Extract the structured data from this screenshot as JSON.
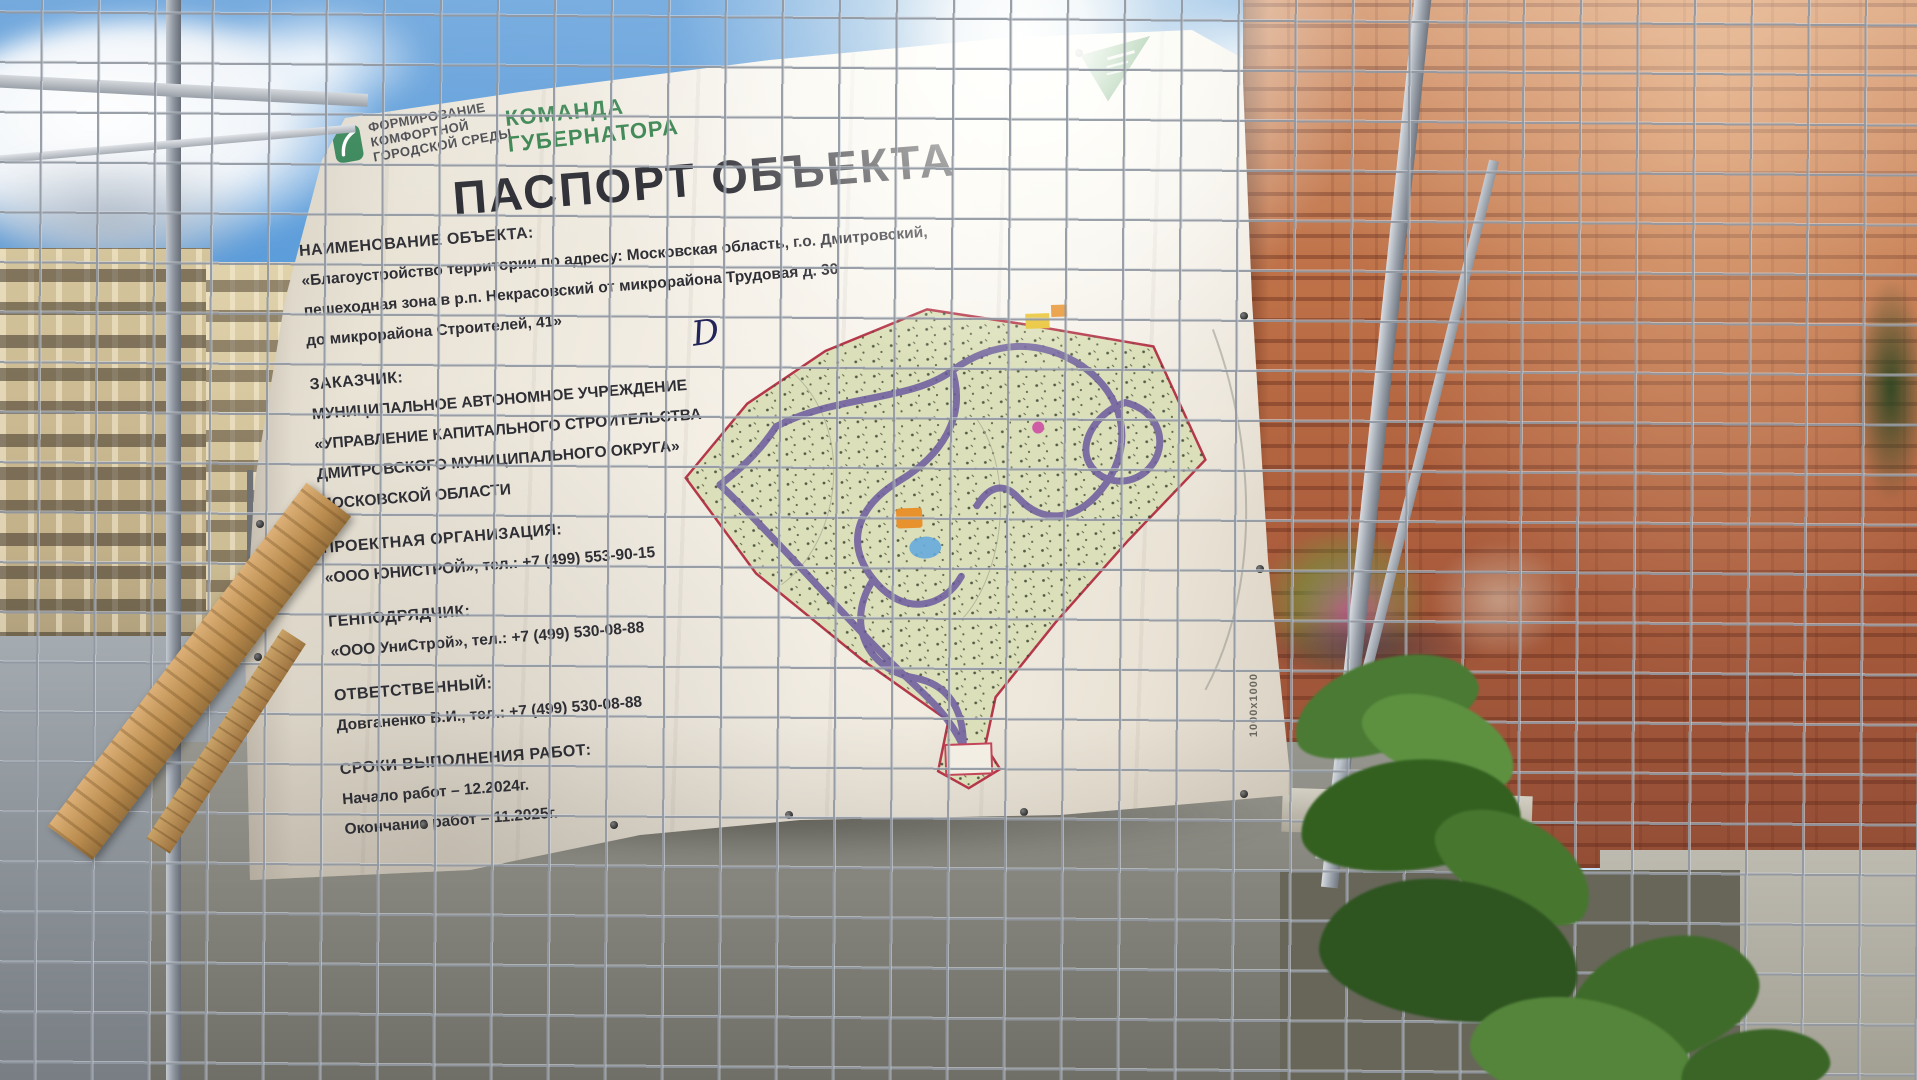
{
  "banner": {
    "program_logo": {
      "lines": [
        "ФОРМИРОВАНИЕ",
        "КОМФОРТНОЙ",
        "ГОРОДСКОЙ СРЕДЫ"
      ]
    },
    "governor_team": {
      "lines": [
        "КОМАНДА",
        "ГУБЕРНАТОРА"
      ]
    },
    "title": "ПАСПОРТ ОБЪЕКТА",
    "sections": [
      {
        "heading": "НАИМЕНОВАНИЕ ОБЪЕКТА:",
        "lines": [
          "«Благоустройство территории по адресу: Московская область, г.о. Дмитровский,",
          "пешеходная зона в р.п. Некрасовский от микрорайона Трудовая д. 30",
          "до микрорайона Строителей, 41»"
        ]
      },
      {
        "heading": "ЗАКАЗЧИК:",
        "lines": [
          "МУНИЦИПАЛЬНОЕ АВТОНОМНОЕ УЧРЕЖДЕНИЕ",
          "«УПРАВЛЕНИЕ КАПИТАЛЬНОГО СТРОИТЕЛЬСТВА",
          "ДМИТРОВСКОГО МУНИЦИПАЛЬНОГО ОКРУГА»",
          "МОСКОВСКОЙ ОБЛАСТИ"
        ]
      },
      {
        "heading": "ПРОЕКТНАЯ ОРГАНИЗАЦИЯ:",
        "lines": [
          "«ООО ЮНИСТРОЙ», тел.: +7 (499) 553-90-15"
        ]
      },
      {
        "heading": "ГЕНПОДРЯДЧИК:",
        "lines": [
          "«ООО УниСтрой», тел.: +7 (499) 530-08-88"
        ]
      },
      {
        "heading": "ОТВЕТСТВЕННЫЙ:",
        "lines": [
          "Довганенко В.И., тел.: +7 (499) 530-08-88"
        ]
      },
      {
        "heading": "СРОКИ ВЫПОЛНЕНИЯ РАБОТ:",
        "lines": [
          "Начало работ – 12.2024г.",
          "Окончание работ – 11.2025г."
        ]
      }
    ],
    "map_annotation": "D",
    "size_marking": "1000x1000"
  },
  "colors": {
    "logo_green": "#2e7d46",
    "banner_bg": "#efe9dd",
    "text_dark": "#2b2b31",
    "map_fill": "#dce0ba",
    "map_boundary": "#b5374a",
    "map_road": "#6c5b9e",
    "brick": "#b06544"
  }
}
